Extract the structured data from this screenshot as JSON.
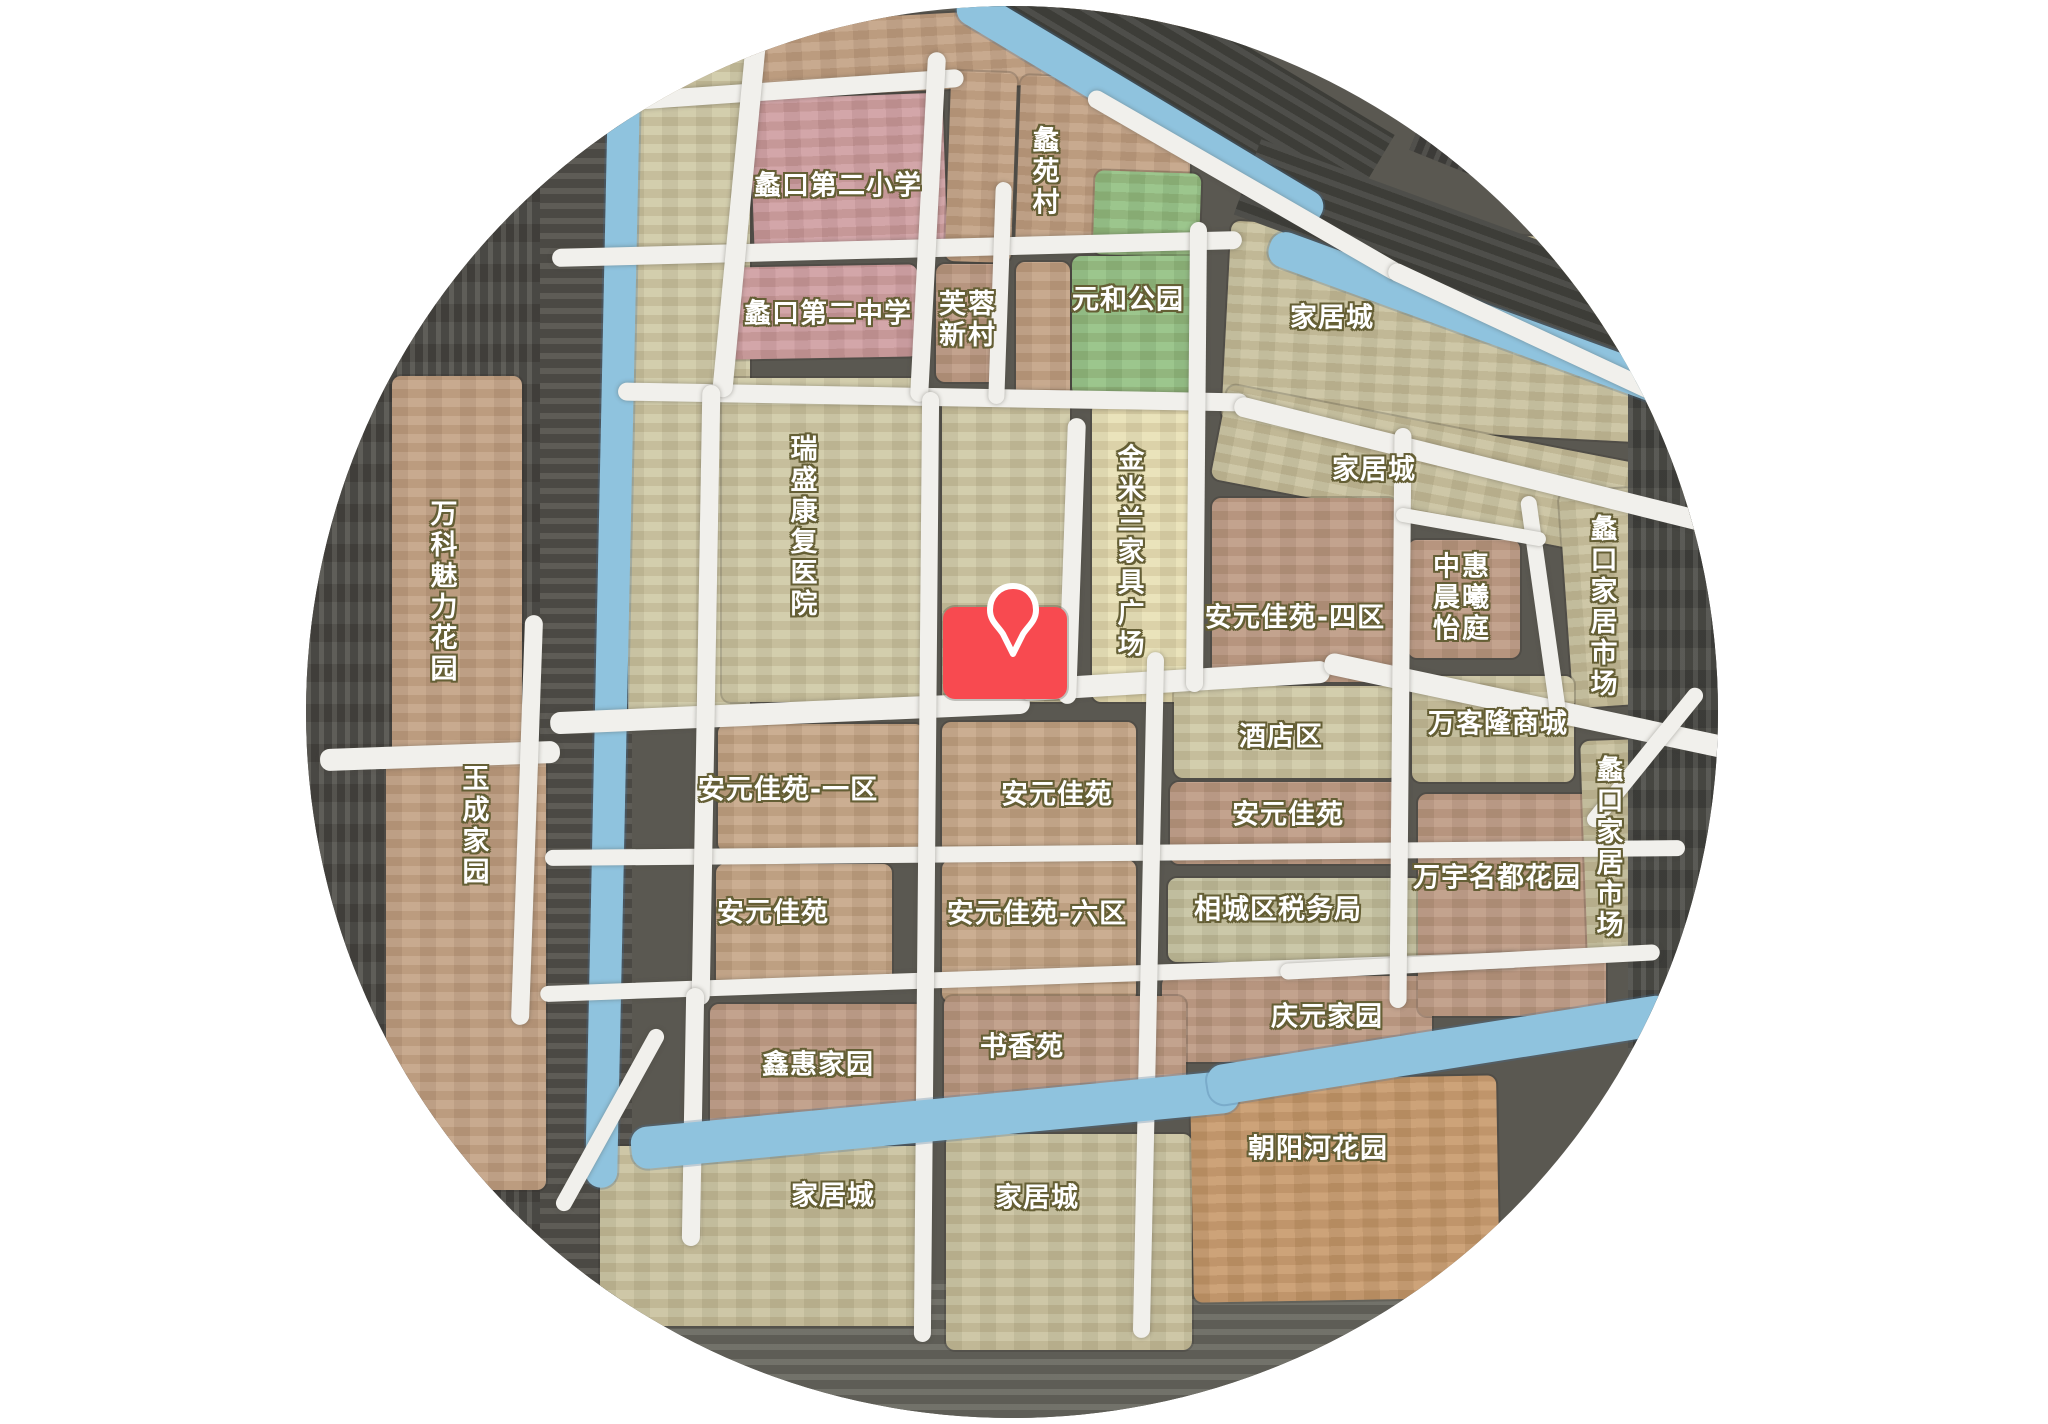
{
  "map": {
    "labels": {
      "primary_school": "蠡口第二小学",
      "liyuan_village": "蠡苑村",
      "middle_school": "蠡口第二中学",
      "furong_xincun": "芙蓉新村",
      "yuanhe_park": "元和公园",
      "jiajucheng_top": "家居城",
      "jiajucheng_mid": "家居城",
      "ruisheng_hospital": "瑞盛康复医院",
      "jinmilan_plaza": "金米兰家具广场",
      "wanke_meili_garden": "万科魅力花园",
      "anyuan_4": "安元佳苑-四区",
      "zhonghui_chenxi": "中惠晨曦怡庭",
      "likou_market_upper": "蠡口家居市场",
      "likou_market_lower": "蠡口家居市场",
      "wankelong_mall": "万客隆商城",
      "hotel_district": "酒店区",
      "anyuan_1": "安元佳苑-一区",
      "anyuan_center": "安元佳苑",
      "anyuan_east": "安元佳苑",
      "anyuan_west": "安元佳苑",
      "anyuan_6": "安元佳苑-六区",
      "wanyu_mingdu_garden": "万宇名都花园",
      "yucheng_home": "玉成家园",
      "tax_bureau": "相城区税务局",
      "qingyuan_home": "庆元家园",
      "xinhui_home": "鑫惠家园",
      "shuxiang_yuan": "书香苑",
      "chaoyanghe_garden": "朝阳河花园",
      "jiajucheng_sw": "家居城",
      "jiajucheng_s": "家居城"
    },
    "marker": {
      "icon": "location-pin",
      "color": "#f84a50"
    },
    "colors": {
      "school_pink": "#cf9da0",
      "residential_tan": "#c3a284",
      "residential_brown": "#bd9a83",
      "commercial_olive": "#c9c29e",
      "plaza_pale_yellow": "#e8e0b4",
      "park_green": "#92c082",
      "river_blue": "#8fc3de",
      "road_white": "#f1f0ec",
      "highlight_red": "#f84a50",
      "label_outline": "#655f35"
    }
  }
}
